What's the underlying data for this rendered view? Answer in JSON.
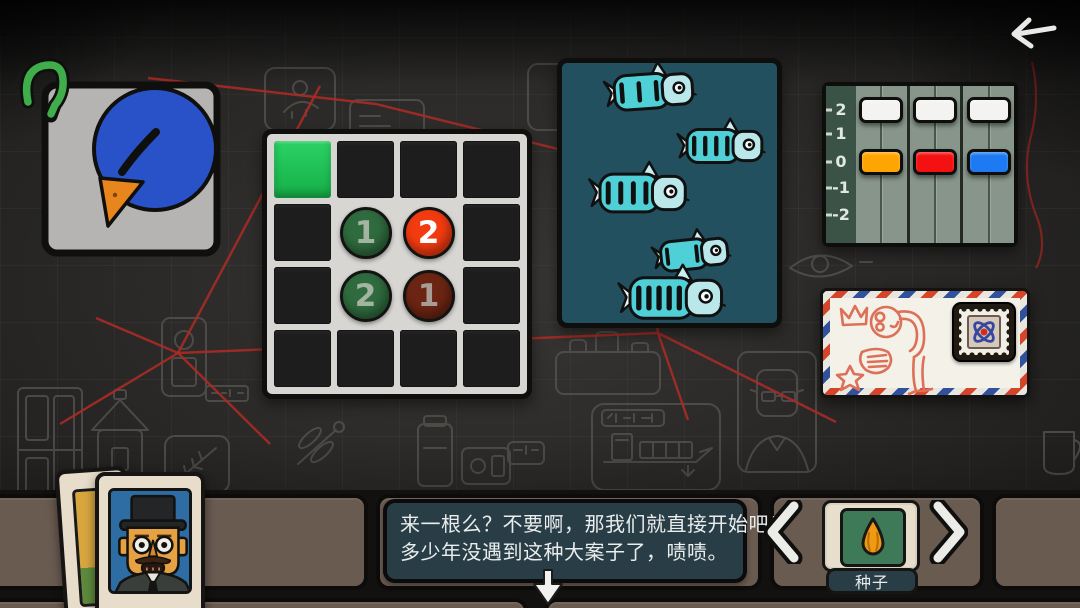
{
  "header": {
    "back_icon": "arrow-left"
  },
  "board": {
    "string_color": "#ad2b25",
    "red_strings": [
      [
        178,
        353,
        320,
        86
      ],
      [
        178,
        353,
        60,
        424
      ],
      [
        178,
        353,
        270,
        444
      ],
      [
        178,
        353,
        96,
        318
      ],
      [
        178,
        353,
        658,
        333
      ],
      [
        658,
        333,
        688,
        420
      ],
      [
        658,
        333,
        648,
        236
      ],
      [
        658,
        333,
        836,
        422
      ],
      [
        148,
        78,
        376,
        104
      ],
      [
        376,
        104,
        562,
        150
      ]
    ]
  },
  "evidence": {
    "bird_card": "blue-bird-photo",
    "worm": "green-worm"
  },
  "grid_puzzle": {
    "rows": 4,
    "cols": 4,
    "green_cell_color": "#1ec455",
    "cells": [
      [
        {
          "bg": "green"
        },
        {
          "bg": "dark"
        },
        {
          "bg": "dark"
        },
        {
          "bg": "dark"
        }
      ],
      [
        {
          "bg": "dark"
        },
        {
          "bg": "light",
          "circle": {
            "value": "1",
            "fill": "#2f6b3e",
            "text": "#a3b5a0"
          }
        },
        {
          "bg": "light",
          "circle": {
            "value": "2",
            "fill": "#f33b10",
            "text": "#ffffff"
          }
        },
        {
          "bg": "dark"
        }
      ],
      [
        {
          "bg": "dark"
        },
        {
          "bg": "light",
          "circle": {
            "value": "2",
            "fill": "#2f6b3e",
            "text": "#a3b5a0"
          }
        },
        {
          "bg": "light",
          "circle": {
            "value": "1",
            "fill": "#6d2513",
            "text": "#a89d94"
          }
        },
        {
          "bg": "dark"
        }
      ],
      [
        {
          "bg": "dark"
        },
        {
          "bg": "dark"
        },
        {
          "bg": "dark"
        },
        {
          "bg": "dark"
        }
      ]
    ]
  },
  "fish_panel": {
    "bg_color": "#23505f",
    "fish": [
      {
        "x": 95,
        "y": 33,
        "len": 75,
        "stripes": 3,
        "tilt": -4
      },
      {
        "x": 166,
        "y": 88,
        "len": 72,
        "stripes": 4,
        "tilt": 0
      },
      {
        "x": 84,
        "y": 135,
        "len": 82,
        "stripes": 4,
        "tilt": 0
      },
      {
        "x": 136,
        "y": 196,
        "len": 64,
        "stripes": 2,
        "tilt": -6
      },
      {
        "x": 117,
        "y": 240,
        "len": 88,
        "stripes": 5,
        "tilt": 0
      }
    ]
  },
  "slider_panel": {
    "scale_labels": [
      "2",
      "1",
      "0",
      "-1",
      "-2"
    ],
    "tracks": [
      {
        "handles": [
          {
            "color": "#f3f3f1",
            "row": 0
          },
          {
            "color": "#ffa502",
            "row": 2
          }
        ]
      },
      {
        "handles": [
          {
            "color": "#f3f3f1",
            "row": 0
          },
          {
            "color": "#f41111",
            "row": 2
          }
        ]
      },
      {
        "handles": [
          {
            "color": "#f3f3f1",
            "row": 0
          },
          {
            "color": "#1d7af2",
            "row": 2
          }
        ]
      }
    ]
  },
  "envelope": {
    "stamp_icon": "atom-stamp-icon",
    "doodle": "bowing-figure-with-crown-and-star"
  },
  "dialogue": {
    "line1": "来一根么？不要啊，那我们就直接开始吧！",
    "line2": "多少年没遇到这种大案子了，啧啧。"
  },
  "inventory": {
    "item_label": "种子",
    "item_icon": "seed-icon",
    "prev_icon": "chevron-left",
    "next_icon": "chevron-right"
  }
}
